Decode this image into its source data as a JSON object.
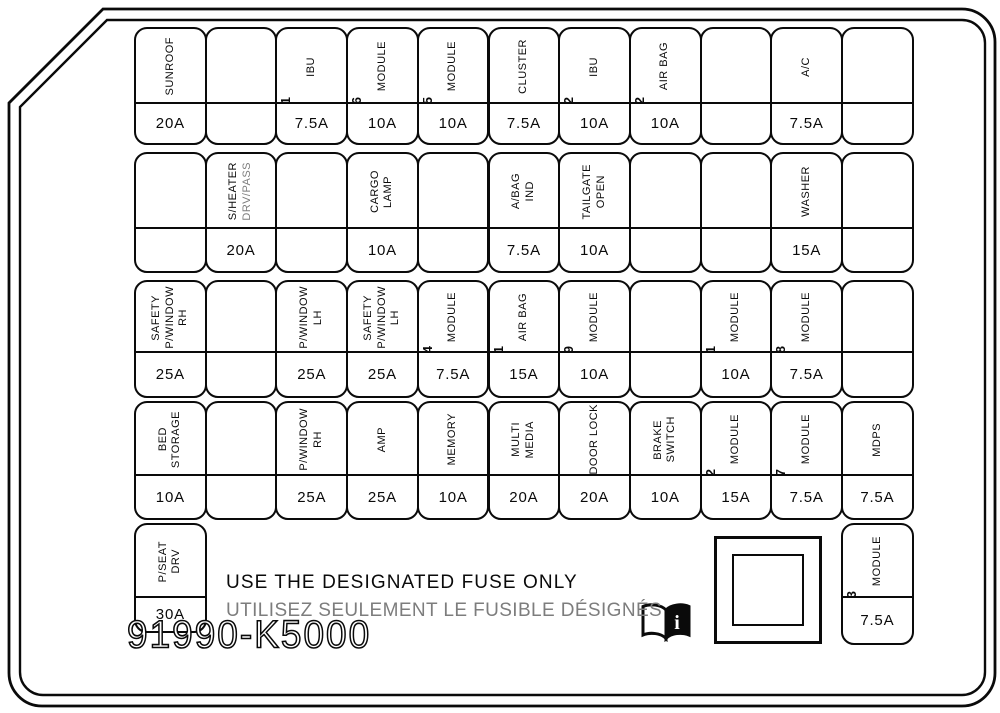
{
  "diagram": {
    "part_number": "91990-K5000",
    "notice_line_1": "USE THE DESIGNATED FUSE ONLY",
    "notice_line_2": "UTILISEZ SEULEMENT LE FUSIBLE DÉSIGNÉS",
    "colors": {
      "line": "#0a0a0a",
      "gray_text": "#7d7d7d",
      "background": "#ffffff"
    },
    "icon": "owners-manual-icon"
  },
  "fuse_rows": [
    {
      "cells": [
        {
          "label": [
            "SUNROOF"
          ],
          "amp": "20A"
        },
        {},
        {
          "num": "1",
          "label": [
            "IBU"
          ],
          "amp": "7.5A"
        },
        {
          "num": "6",
          "label": [
            "MODULE"
          ],
          "amp": "10A"
        },
        {
          "num": "5",
          "label": [
            "MODULE"
          ],
          "amp": "10A"
        },
        {
          "label": [
            "CLUSTER"
          ],
          "amp": "7.5A"
        },
        {
          "num": "2",
          "label": [
            "IBU"
          ],
          "amp": "10A"
        },
        {
          "num": "2",
          "label": [
            "AIR BAG"
          ],
          "amp": "10A"
        },
        {},
        {
          "label": [
            "A/C"
          ],
          "amp": "7.5A"
        },
        {}
      ]
    },
    {
      "cells": [
        {},
        {
          "label": [
            "S/HEATER",
            {
              "t": "DRV/PASS",
              "gray": true
            }
          ],
          "amp": "20A"
        },
        {},
        {
          "label": [
            "CARGO",
            "LAMP"
          ],
          "amp": "10A"
        },
        {},
        {
          "label": [
            "A/BAG",
            "IND"
          ],
          "amp": "7.5A"
        },
        {
          "label": [
            "TAILGATE",
            "OPEN"
          ],
          "amp": "10A"
        },
        {},
        {},
        {
          "label": [
            "WASHER"
          ],
          "amp": "15A"
        },
        {}
      ]
    },
    {
      "cells": [
        {
          "label": [
            "SAFETY",
            "P/WINDOW",
            "RH"
          ],
          "amp": "25A"
        },
        {},
        {
          "label": [
            "P/WINDOW",
            "LH"
          ],
          "amp": "25A"
        },
        {
          "label": [
            "SAFETY",
            "P/WINDOW",
            "LH"
          ],
          "amp": "25A"
        },
        {
          "num": "4",
          "label": [
            "MODULE"
          ],
          "amp": "7.5A"
        },
        {
          "num": "1",
          "label": [
            "AIR BAG"
          ],
          "amp": "15A"
        },
        {
          "num": "9",
          "label": [
            "MODULE"
          ],
          "amp": "10A"
        },
        {},
        {
          "num": "1",
          "label": [
            "MODULE"
          ],
          "amp": "10A"
        },
        {
          "num": "8",
          "label": [
            "MODULE"
          ],
          "amp": "7.5A"
        },
        {}
      ]
    },
    {
      "cells": [
        {
          "label": [
            "BED",
            "STORAGE"
          ],
          "amp": "10A"
        },
        {},
        {
          "label": [
            "P/WINDOW",
            "RH"
          ],
          "amp": "25A"
        },
        {
          "label": [
            "AMP"
          ],
          "amp": "25A"
        },
        {
          "label": [
            "MEMORY"
          ],
          "amp": "10A"
        },
        {
          "label": [
            "MULTI",
            "MEDIA"
          ],
          "amp": "20A"
        },
        {
          "label": [
            "DOOR LOCK"
          ],
          "amp": "20A"
        },
        {
          "label": [
            "BRAKE",
            "SWITCH"
          ],
          "amp": "10A"
        },
        {
          "num": "2",
          "label": [
            "MODULE"
          ],
          "amp": "15A"
        },
        {
          "num": "7",
          "label": [
            "MODULE"
          ],
          "amp": "7.5A"
        },
        {
          "label": [
            "MDPS"
          ],
          "amp": "7.5A"
        }
      ]
    },
    {
      "cells": [
        {
          "col": 0,
          "label": [
            "P/SEAT",
            "DRV"
          ],
          "amp": "30A"
        },
        {
          "col": 10,
          "num": "3",
          "label": [
            "MODULE"
          ],
          "amp": "7.5A"
        }
      ]
    }
  ]
}
